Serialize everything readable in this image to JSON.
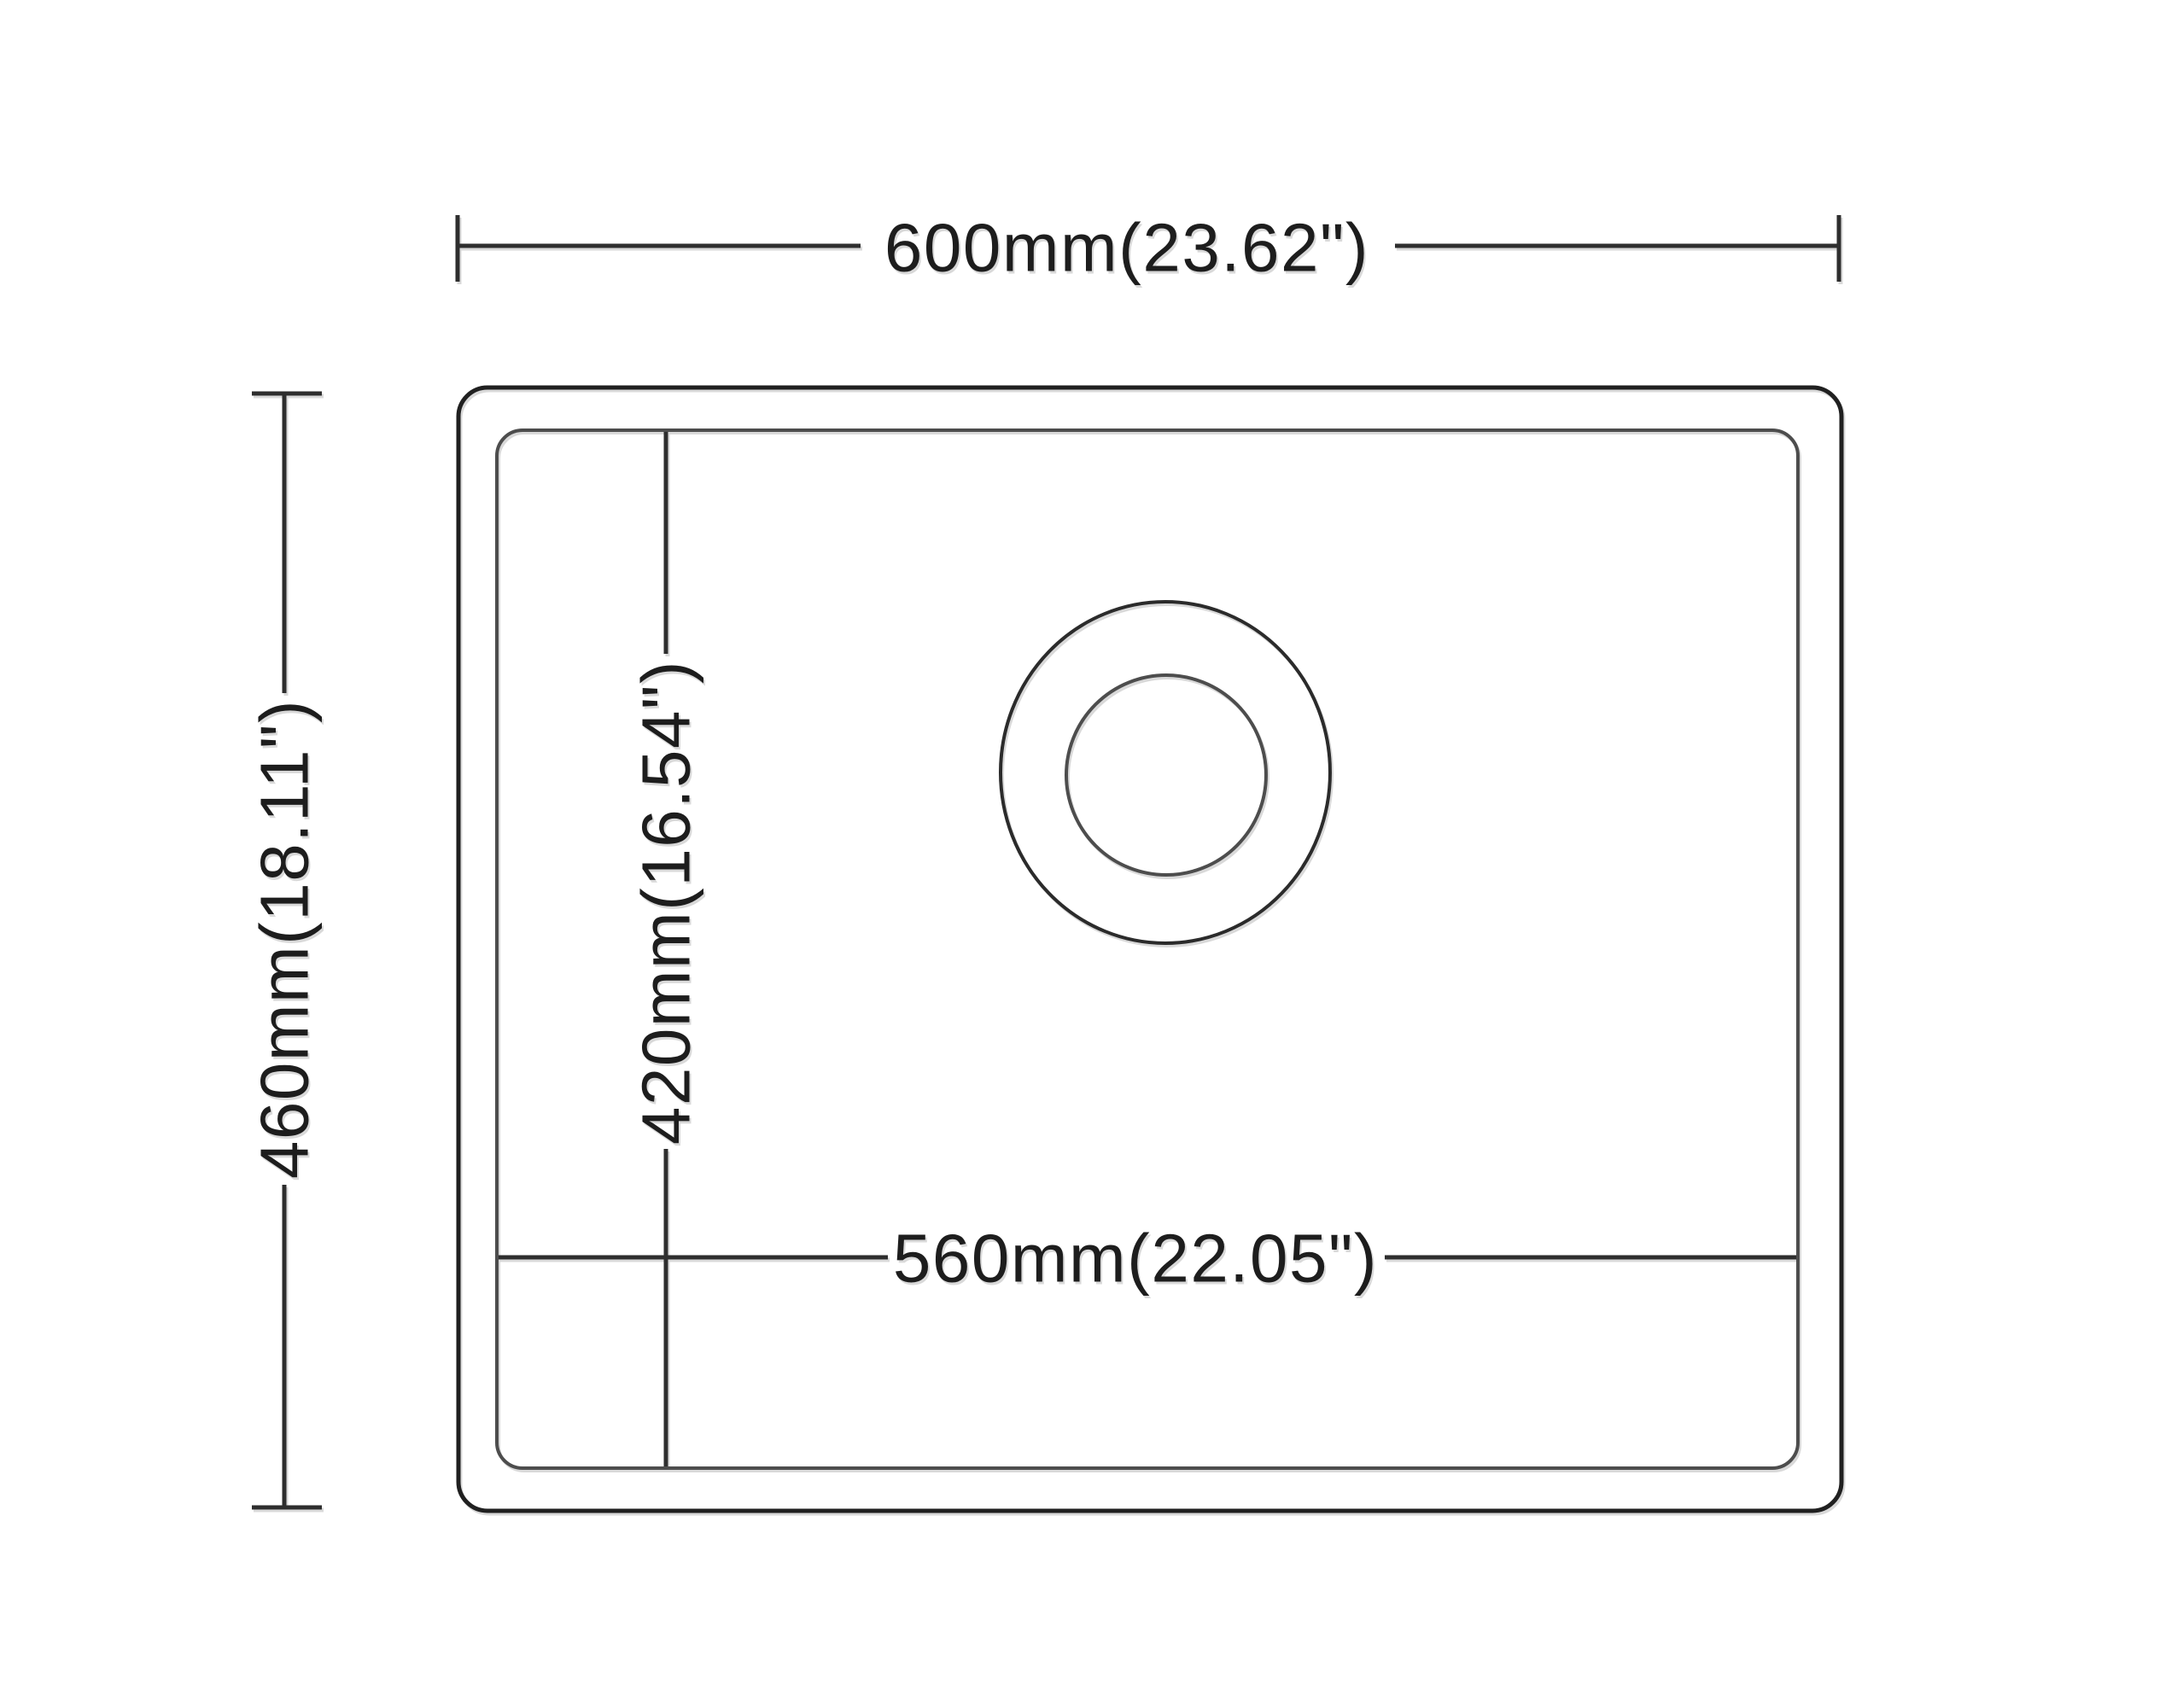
{
  "colors": {
    "background": "#ffffff",
    "outer_outline": "#202020",
    "inner_outline": "#4d4d4d",
    "dimension_line": "#2e2e2e",
    "label_text": "#1d1d1d"
  },
  "diagram": {
    "type": "technical-dimension-drawing",
    "dimensions": {
      "overall_width": {
        "label": "600mm(23.62\")",
        "mm": 600,
        "inches": 23.62
      },
      "overall_depth": {
        "label": "460mm(18.11\")",
        "mm": 460,
        "inches": 18.11
      },
      "inner_width": {
        "label": "560mm(22.05\")",
        "mm": 560,
        "inches": 22.05
      },
      "inner_depth": {
        "label": "420mm(16.54\")",
        "mm": 420,
        "inches": 16.54
      }
    }
  }
}
